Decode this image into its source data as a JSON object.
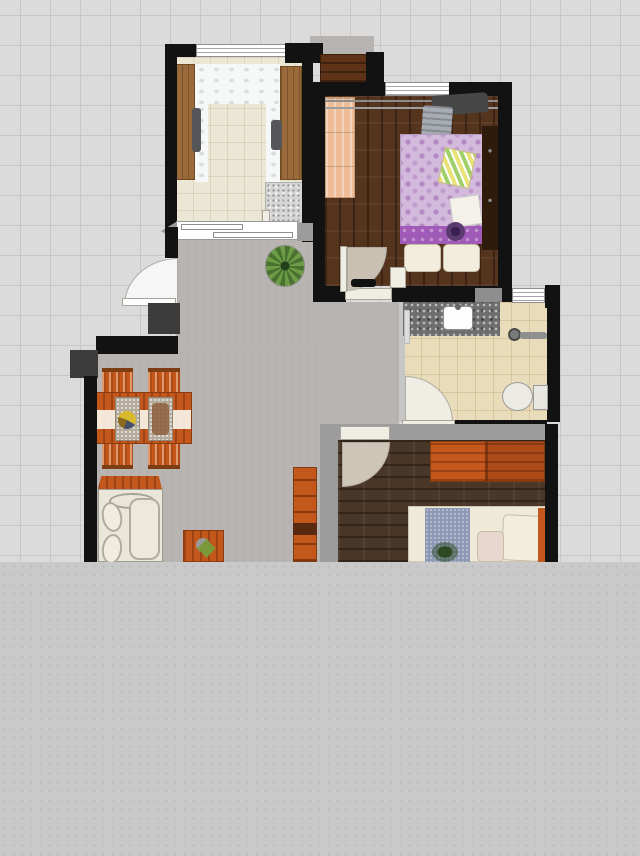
{
  "app": {
    "view": "floor-plan-canvas",
    "visible_text": ""
  },
  "palette": {
    "grid_bg": "#dbdbdb",
    "grid_line": "#c7c7c7",
    "panel_bg": "#c9c9c9",
    "panel_dot": "#bababa",
    "wall": "#121212",
    "block": "#3c3c3c",
    "gray_wall": "#9c9c9c",
    "hall_floor": "#b7b4b1",
    "balcony_floor": "#ece6d4",
    "bath_floor": "#e9dcba",
    "wood_dark": "#55341d",
    "wood_master": "#4a3626",
    "orange": "#c4571c",
    "orange_dark": "#8a3c10",
    "peach": "#eebd98",
    "purple": "#d3b9dc",
    "purple_band": "#a05ab8",
    "cream": "#efe9da",
    "blue": "#8d99b4",
    "granite": "#6e6e6e",
    "shoe_brown": "#5f3317",
    "cabinet_brown": "#9a6a3a",
    "dark_cabinet": "#2e1b0c",
    "plant_green": "#5d8a3c",
    "door_white": "#f0ede5",
    "window_white": "#ffffff"
  },
  "floorplan": {
    "rooms": [
      {
        "id": "balcony-study",
        "floor": "beige-tile"
      },
      {
        "id": "bedroom",
        "floor": "dark-wood"
      },
      {
        "id": "bathroom",
        "floor": "beige-tile"
      },
      {
        "id": "master-bedroom",
        "floor": "dark-wood"
      },
      {
        "id": "living-dining-hall",
        "floor": "gray-concrete"
      },
      {
        "id": "entry",
        "floor": "gray-concrete"
      }
    ],
    "furniture": [
      "study-cabinet-left",
      "study-cabinet-right",
      "study-counter",
      "study-chair-left",
      "study-chair-right",
      "washing-machine",
      "shoe-cabinet",
      "clothes-rail",
      "hanging-clothes",
      "peach-wardrobe",
      "double-bed-purple",
      "bed-pillows",
      "striped-blanket",
      "bed-tray",
      "round-hat",
      "tall-cabinet",
      "vanity-counter",
      "sink",
      "shower-mixer",
      "toilet",
      "towel-rail",
      "dining-table",
      "table-runner",
      "placemat-left",
      "placemat-right",
      "dining-chairs",
      "sofa",
      "console-table",
      "coffee-table",
      "coffee-table-plant",
      "potted-plant",
      "bookshelf",
      "master-wardrobe",
      "master-bed",
      "bed-runner-blue",
      "master-pillows",
      "bed-plant-decor"
    ],
    "openings": [
      "balcony-window",
      "balcony-sliding-door",
      "entry-door",
      "bedroom-window",
      "bedroom-door",
      "bathroom-window",
      "bathroom-door",
      "master-door"
    ]
  }
}
